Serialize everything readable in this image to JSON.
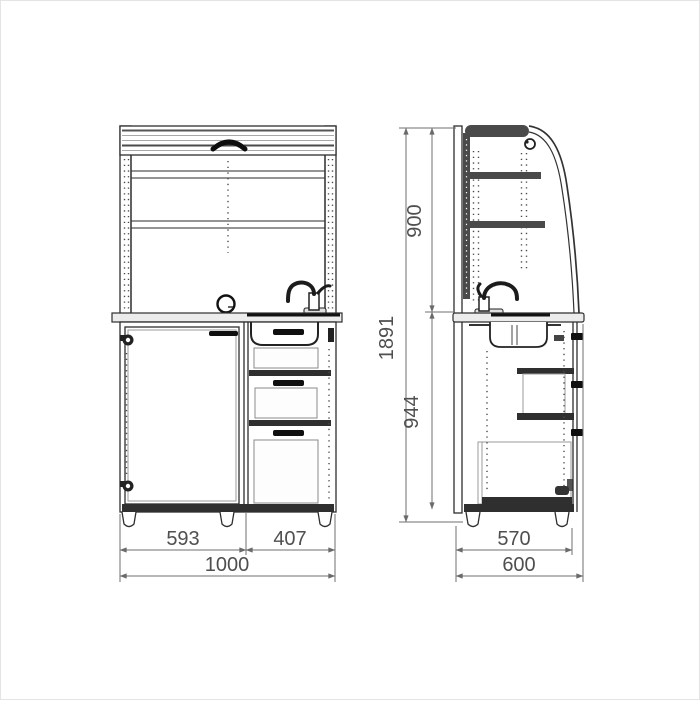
{
  "page": {
    "background_color": "#ffffff",
    "frame_color": "#e4e4e4"
  },
  "drawing": {
    "outline_color": "#2e2e2e",
    "dark_fill_color": "#2f2f2f",
    "worktop_fill_color": "#ececec",
    "dim_line_color": "#6f6f6f",
    "dim_text_color": "#4f4f4f"
  },
  "front_view": {
    "dims": {
      "door_width_mm": "593",
      "drawers_width_mm": "407",
      "total_width_mm": "1000"
    }
  },
  "side_view": {
    "dims": {
      "upper_height_mm": "900",
      "total_height_mm": "1891",
      "base_height_mm": "944",
      "body_depth_mm": "570",
      "total_depth_mm": "600"
    }
  }
}
